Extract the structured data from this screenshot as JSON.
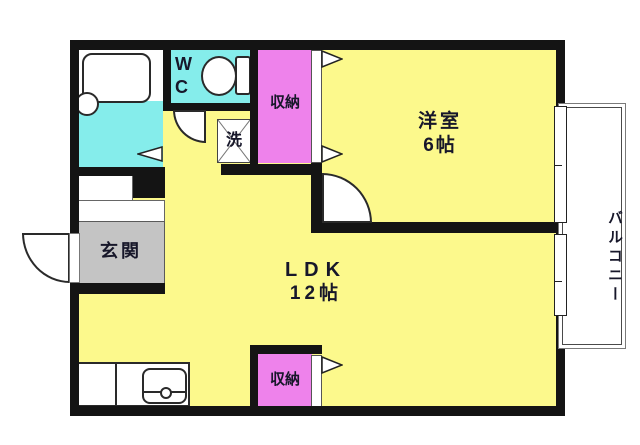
{
  "labels": {
    "wc": "W\nC",
    "laundry": "洗",
    "closet_upper": "収納",
    "closet_lower": "収納",
    "western_room_name": "洋室",
    "western_room_size": "6帖",
    "ldk_name": "LDK",
    "ldk_size": "12帖",
    "entrance": "玄関",
    "balcony": "バルコニー"
  },
  "colors": {
    "room_yellow": "#FCF98C",
    "wet_cyan": "#85EDEB",
    "closet_pink": "#EE82EB",
    "entrance_gray": "#C4C4C4",
    "wall_black": "#141414"
  }
}
